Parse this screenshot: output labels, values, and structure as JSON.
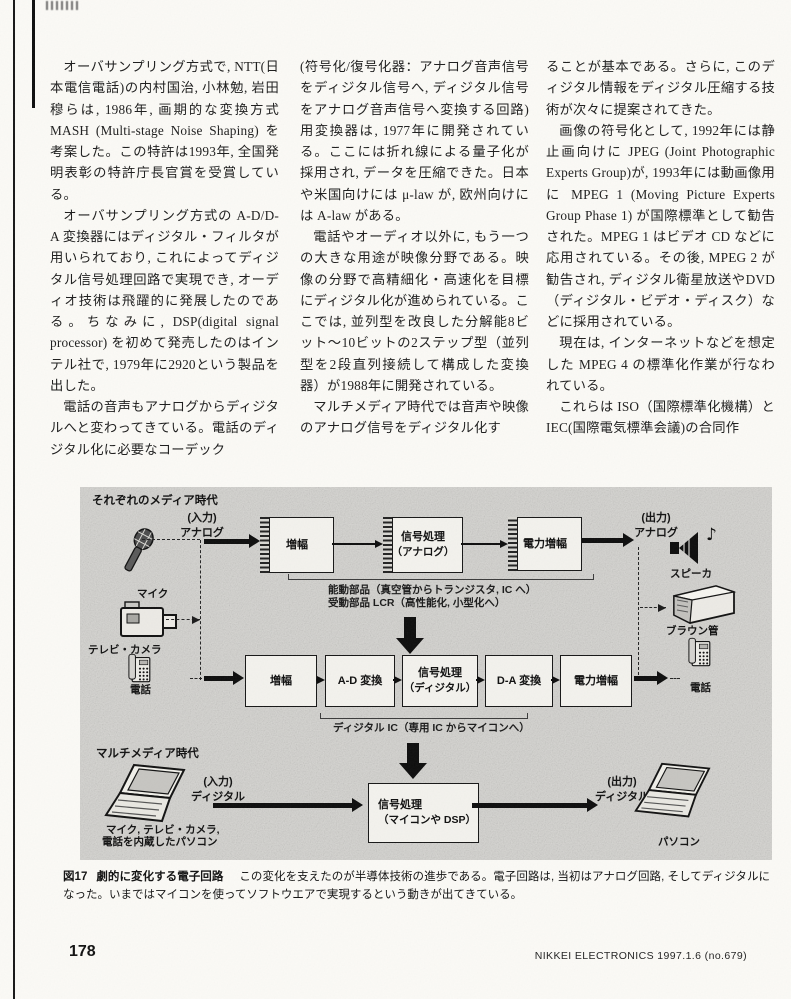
{
  "article": {
    "col1": {
      "p1": "オーバサンプリング方式で, NTT(日本電信電話)の内村国治, 小林勉, 岩田穆らは, 1986年, 画期的な変換方式MASH (Multi-stage Noise Shaping) を考案した。この特許は1993年, 全国発明表彰の特許庁長官賞を受賞している。",
      "p2": "オーバサンプリング方式の A-D/D-A 変換器にはディジタル・フィルタが用いられており, これによってディジタル信号処理回路で実現でき, オーディオ技術は飛躍的に発展したのである。ちなみに, DSP(digital signal processor) を初めて発売したのはインテル社で, 1979年に2920という製品を出した。",
      "p3": "電話の音声もアナログからディジタルへと変わってきている。電話のディジタル化に必要なコーデック"
    },
    "col2": {
      "p1": "(符号化/復号化器：アナログ音声信号をディジタル信号へ, ディジタル信号をアナログ音声信号へ変換する回路)用変換器は, 1977年に開発されている。ここには折れ線による量子化が採用され, データを圧縮できた。日本や米国向けには μ-law が, 欧州向けには A-law がある。",
      "p2": "電話やオーディオ以外に, もう一つの大きな用途が映像分野である。映像の分野で高精細化・高速化を目標にディジタル化が進められている。ここでは, 並列型を改良した分解能8ビット〜10ビットの2ステップ型（並列型を2段直列接続して構成した変換器）が1988年に開発されている。",
      "p3": "マルチメディア時代では音声や映像のアナログ信号をディジタル化す"
    },
    "col3": {
      "p1": "ることが基本である。さらに, このディジタル情報をディジタル圧縮する技術が次々に提案されてきた。",
      "p2": "画像の符号化として, 1992年には静止画向けに JPEG (Joint Photographic Experts Group)が, 1993年には動画像用に MPEG 1 (Moving Picture Experts Group Phase 1) が国際標準として勧告された。MPEG 1 はビデオ CD などに応用されている。その後, MPEG 2 が勧告され, ディジタル衛星放送やDVD（ディジタル・ビデオ・ディスク）などに採用されている。",
      "p3": "現在は, インターネットなどを想定した MPEG 4 の標準化作業が行なわれている。",
      "p4": "これらは ISO（国際標準化機構）と IEC(国際電気標準会議)の合同作"
    }
  },
  "figure": {
    "era1": "それぞれのメディア時代",
    "era2": "マルチメディア時代",
    "io": {
      "in_analog_1": "(入力)",
      "in_analog_2": "アナログ",
      "out_analog_1": "(出力)",
      "out_analog_2": "アナログ",
      "in_digital_1": "(入力)",
      "in_digital_2": "ディジタル",
      "out_digital_1": "(出力)",
      "out_digital_2": "ディジタル"
    },
    "devices": {
      "mic": "マイク",
      "tvcamera": "テレビ・カメラ",
      "phone_left": "電話",
      "speaker": "スピーカ",
      "music_note": "♪",
      "crt": "ブラウン管",
      "phone_right": "電話",
      "laptop_line1": "マイク, テレビ・カメラ,",
      "laptop_line2": "電話を内蔵したパソコン",
      "pc": "パソコン"
    },
    "analog_row": [
      {
        "label": "増幅"
      },
      {
        "label": "信号処理",
        "sub": "（アナログ）"
      },
      {
        "label": "電力増幅"
      }
    ],
    "digital_row": [
      {
        "label": "増幅"
      },
      {
        "label": "A-D 変換"
      },
      {
        "label": "信号処理",
        "sub": "（ディジタル）"
      },
      {
        "label": "D-A 変換"
      },
      {
        "label": "電力増幅"
      }
    ],
    "sw_box": {
      "label": "信号処理",
      "sub": "（マイコンや DSP）"
    },
    "notes": {
      "active": "能動部品（真空管からトランジスタ, IC へ）",
      "passive": "受動部品 LCR（高性能化, 小型化へ）",
      "digital_ic": "ディジタル IC（専用 IC からマイコンへ）"
    }
  },
  "caption": {
    "label": "図17",
    "title": "劇的に変化する電子回路",
    "body": "この変化を支えたのが半導体技術の進歩である。電子回路は, 当初はアナログ回路, そしてディジタルになった。いまではマイコンを使ってソフトウエアで実現するという動きが出てきている。"
  },
  "footer": {
    "page_number": "178",
    "journal": "NIKKEI ELECTRONICS 1997.1.6  (no.679)"
  },
  "colors": {
    "figure_bg": "#d4d3cf",
    "ink": "#111111",
    "page_bg": "#fbfaf6"
  }
}
